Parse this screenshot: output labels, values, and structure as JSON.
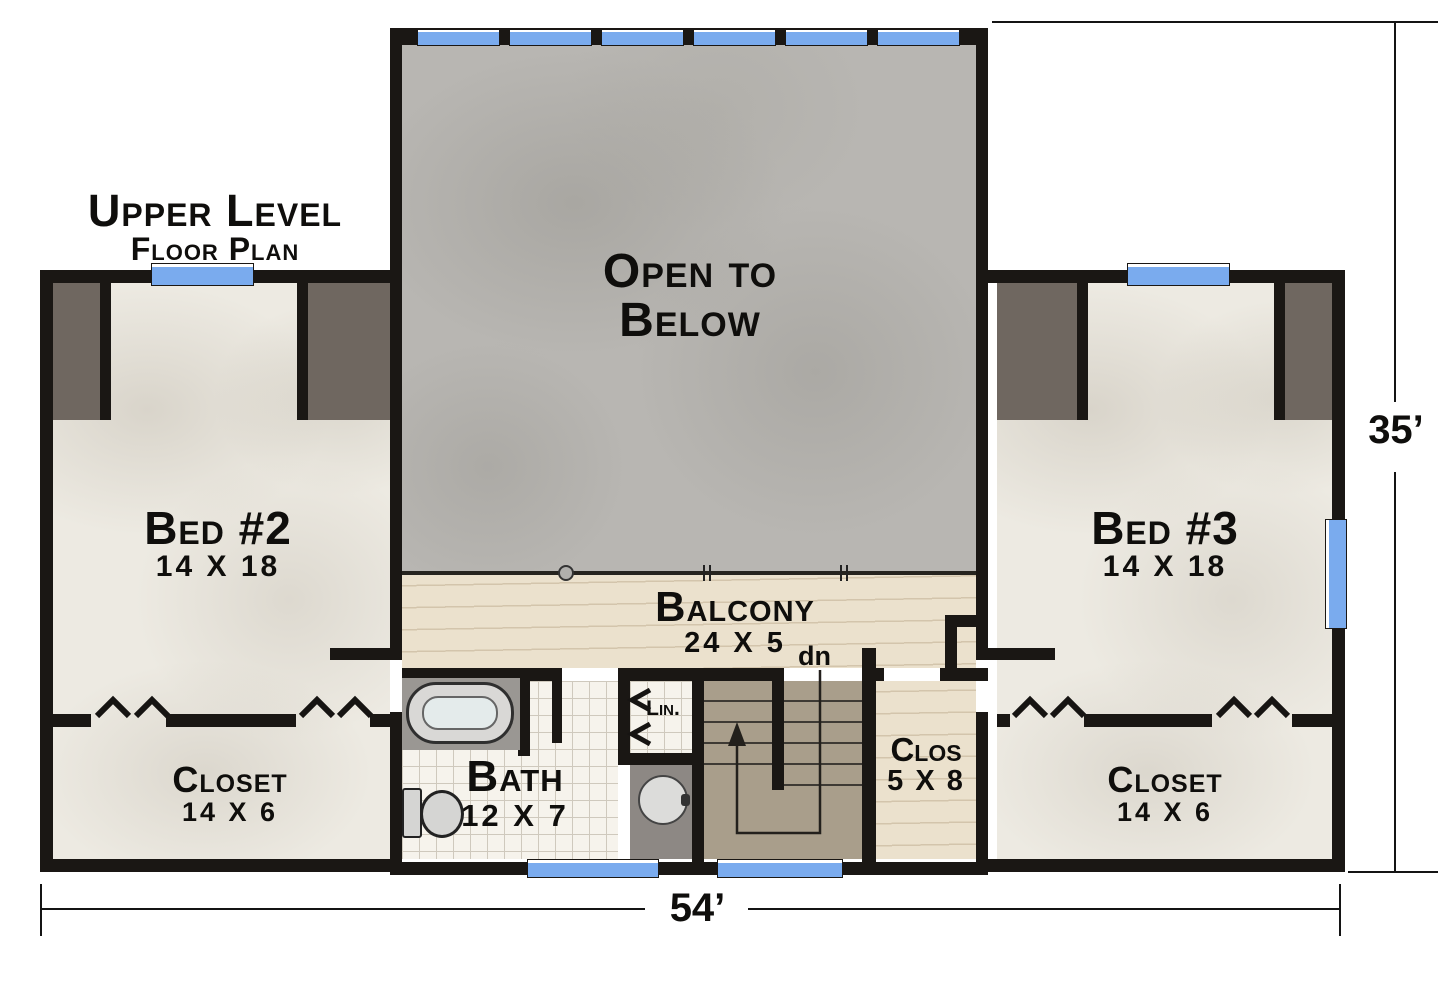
{
  "title": {
    "line1": "Upper Level",
    "line2": "Floor Plan"
  },
  "dimensions": {
    "overall_width": "54’",
    "overall_height": "35’"
  },
  "rooms": {
    "open_below": {
      "line1": "Open to",
      "line2": "Below"
    },
    "bed2": {
      "name": "Bed #2",
      "size": "14 X 18"
    },
    "bed3": {
      "name": "Bed #3",
      "size": "14 X 18"
    },
    "balcony": {
      "name": "Balcony",
      "size": "24 X 5"
    },
    "bath": {
      "name": "Bath",
      "size": "12 X 7"
    },
    "linen": {
      "name": "Lin."
    },
    "clos": {
      "name": "Clos",
      "size": "5 X 8"
    },
    "closet_left": {
      "name": "Closet",
      "size": "14 X 6"
    },
    "closet_right": {
      "name": "Closet",
      "size": "14 X 6"
    },
    "stairs": {
      "label": "dn"
    }
  },
  "colors": {
    "wall": "#1a1714",
    "window_blue": "#7aabee",
    "open_below_gray": "#b8b6b2",
    "wood_floor": "#ebe1cd",
    "room_floor": "#edeae2",
    "stairs_floor": "#a99e8b",
    "attic_space": "#6f6760",
    "bath_tile": "#f6f3ec",
    "vanity_counter": "#8d8884"
  }
}
